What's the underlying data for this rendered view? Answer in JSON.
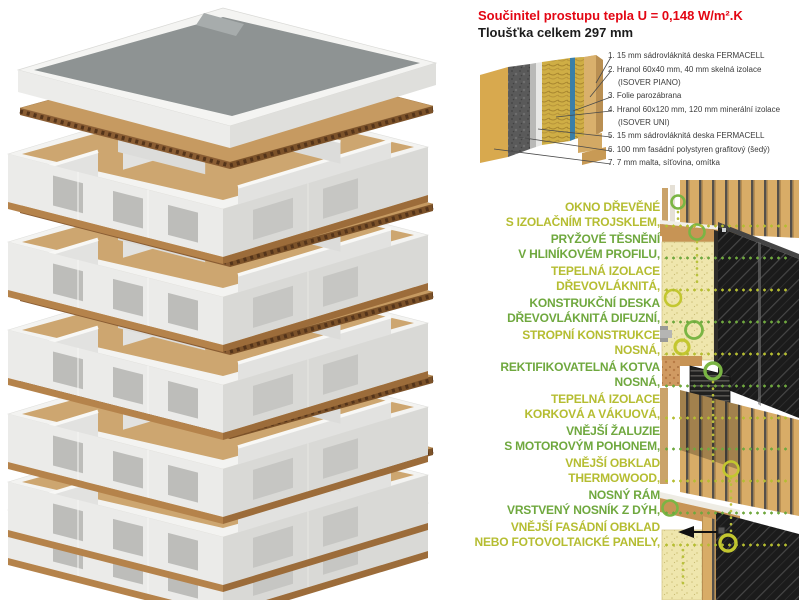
{
  "header": {
    "title": "Součinitel prostupu tepla U = 0,148 W/m².K",
    "subtitle": "Tloušťka celkem 297 mm"
  },
  "legend": {
    "lines": [
      {
        "text": "1. 15 mm sádrovláknitá deska FERMACELL",
        "indent": false
      },
      {
        "text": "2. Hranol 60x40 mm, 40 mm skelná izolace",
        "indent": false
      },
      {
        "text": "(ISOVER PIANO)",
        "indent": true
      },
      {
        "text": "3. Folie parozábrana",
        "indent": false
      },
      {
        "text": "4. Hranol 60x120 mm, 120 mm minerální izolace",
        "indent": false
      },
      {
        "text": "(ISOVER UNI)",
        "indent": true
      },
      {
        "text": "5. 15 mm sádrovláknitá deska FERMACELL",
        "indent": false
      },
      {
        "text": "6. 100 mm fasádní polystyren grafitový (šedý)",
        "indent": false
      },
      {
        "text": "7. 7 mm malta, síťovina, omítka",
        "indent": false
      }
    ]
  },
  "facade_labels": {
    "items": [
      {
        "line1": "OKNO DŘEVĚNÉ",
        "line2": "S IZOLAČNÍM TROJSKLEM,",
        "color": "yellow"
      },
      {
        "line1": "PRYŽOVÉ TĚSNĚNÍ",
        "line2": "V HLINÍKOVÉM PROFILU,",
        "color": "green"
      },
      {
        "line1": "TEPELNÁ IZOLACE",
        "line2": "DŘEVOVLÁKNITÁ,",
        "color": "yellow"
      },
      {
        "line1": "KONSTRUKČNÍ DESKA",
        "line2": "DŘEVOVLÁKNITÁ DIFUZNÍ,",
        "color": "green"
      },
      {
        "line1": "STROPNÍ KONSTRUKCE",
        "line2": "NOSNÁ,",
        "color": "yellow"
      },
      {
        "line1": "REKTIFIKOVATELNÁ KOTVA",
        "line2": "NOSNÁ,",
        "color": "green"
      },
      {
        "line1": "TEPELNÁ IZOLACE",
        "line2": "KORKOVÁ A VÁKUOVÁ,",
        "color": "yellow"
      },
      {
        "line1": "VNĚJŠÍ ŽALUZIE",
        "line2": "S MOTOROVÝM POHONEM,",
        "color": "green"
      },
      {
        "line1": "VNĚJŠÍ OBKLAD",
        "line2": "THERMOWOOD,",
        "color": "yellow"
      },
      {
        "line1": "NOSNÝ RÁM",
        "line2": "VRSTVENÝ NOSNÍK Z DÝH,",
        "color": "green"
      },
      {
        "line1": "VNĚJŠÍ FASÁDNÍ OBKLAD",
        "line2": "NEBO FOTOVOLTAICKÉ PANELY,",
        "color": "yellow"
      }
    ]
  },
  "colors": {
    "title_red": "#e30613",
    "subtitle_black": "#1c1c1c",
    "label_yellow": "#b5bd31",
    "label_green": "#6fa83e",
    "ring_green": "#7ab544",
    "ring_yellow": "#c3c72f",
    "wood": "#c69a61",
    "insulation": "#efe6ad",
    "panel_black": "#1b1b1b"
  }
}
